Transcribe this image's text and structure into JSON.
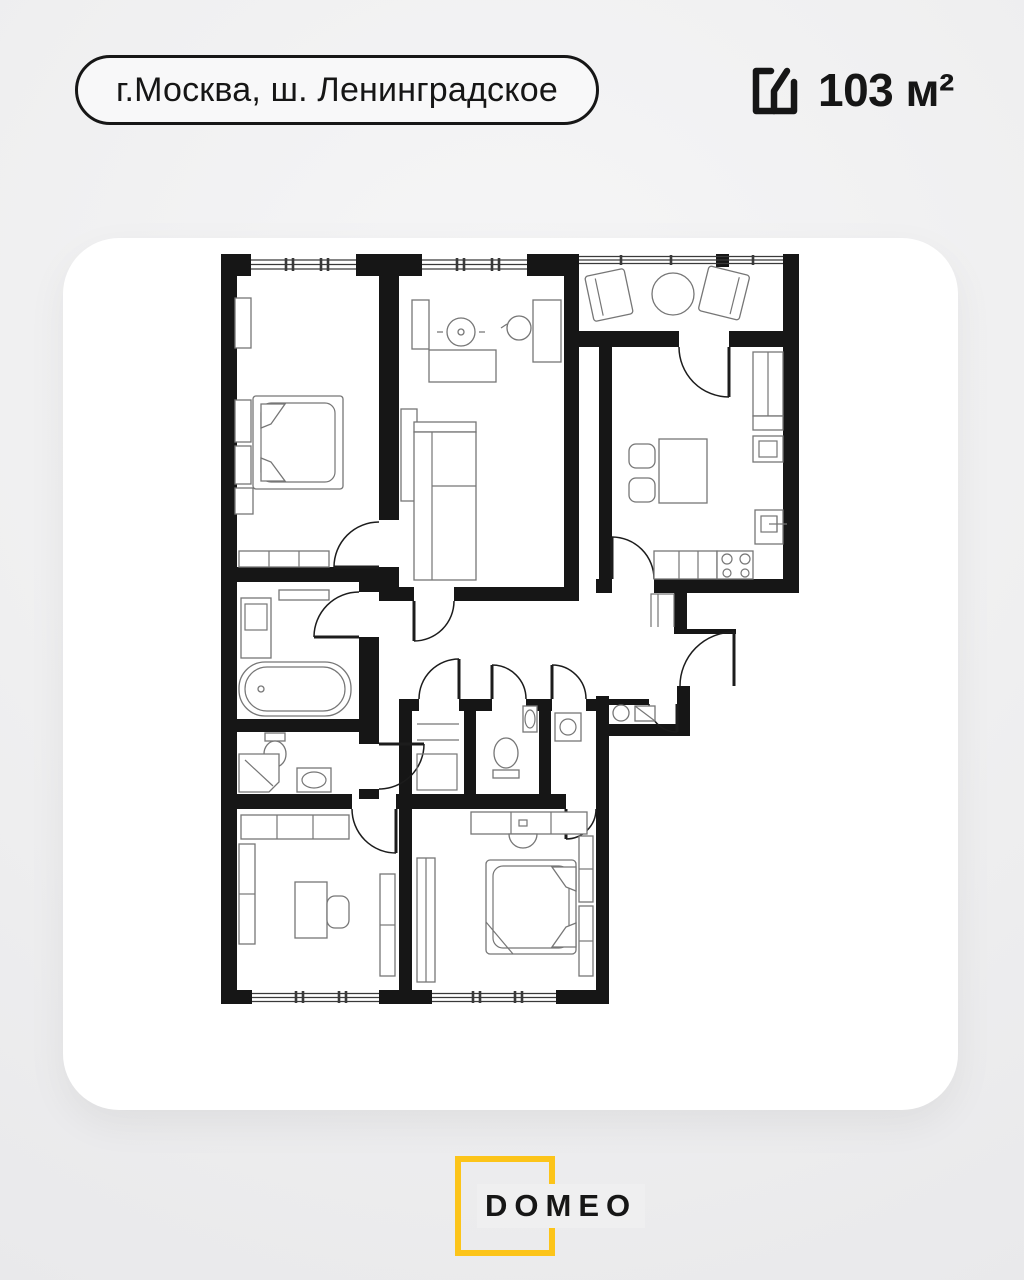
{
  "header": {
    "location": "г.Москва, ш. Ленинградское",
    "area": "103 м²"
  },
  "footer": {
    "brand": "DOMEO"
  },
  "theme": {
    "background": "#efeff0",
    "ink": "#161616",
    "accent_yellow": "#fcc419",
    "card": "#ffffff",
    "furniture_line": "#767676"
  }
}
